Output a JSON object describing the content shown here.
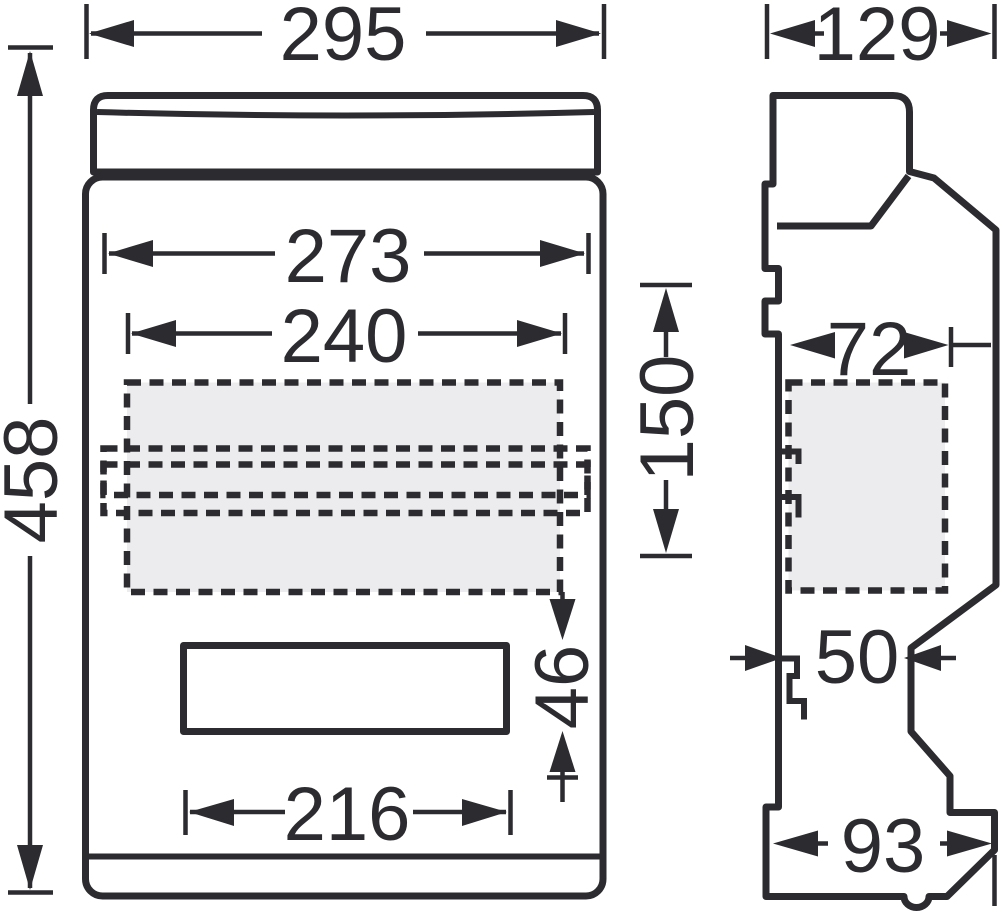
{
  "colors": {
    "line": "#2b2b30",
    "area_fill": "#ececee",
    "background": "#ffffff"
  },
  "views": {
    "front": {
      "dims": {
        "overall_width": "295",
        "overall_height": "458",
        "upper_width": "273",
        "rail_area_width": "240",
        "slot_width": "216",
        "slot_height": "46",
        "rail_offset": "150"
      }
    },
    "side": {
      "dims": {
        "overall_depth": "129",
        "component_depth": "72",
        "clip_depth": "50",
        "base_depth": "93"
      }
    }
  }
}
